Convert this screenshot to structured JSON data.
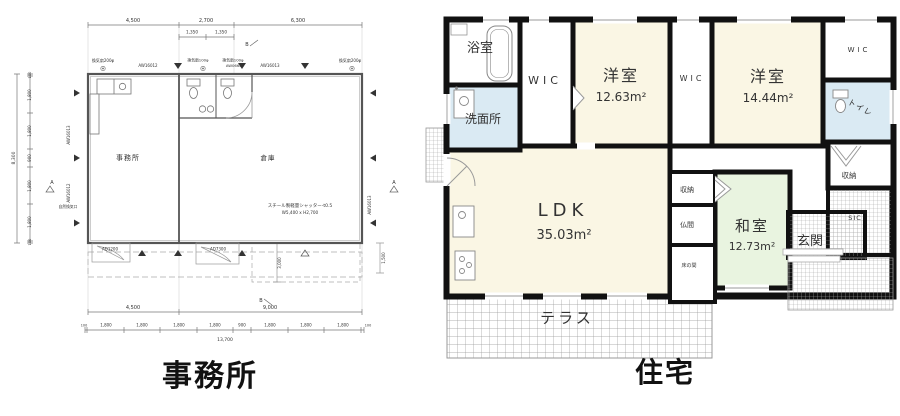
{
  "office": {
    "caption": "事務所",
    "rooms": {
      "office": "事務所",
      "warehouse": "倉庫"
    },
    "dims": {
      "top": [
        "4,500",
        "2,700",
        "6,300"
      ],
      "top_sub": [
        "1,350",
        "1,350"
      ],
      "left": [
        "100",
        "1,800",
        "1,800",
        "900",
        "1,800",
        "1,800",
        "100"
      ],
      "left_total": "8,300",
      "bottom_main": [
        "4,500",
        "9,000"
      ],
      "bottom_detail": [
        "100",
        "1,800",
        "1,800",
        "1,800",
        "1,800",
        "900",
        "1,800",
        "1,800",
        "1,800",
        "100"
      ],
      "bottom_total": "13,700",
      "opening_height": "3,000",
      "canopy_depth": "1,500"
    },
    "notes": {
      "fan200": "換気扇200φ",
      "fan100": "換気扇100φ",
      "aw16012": "AW16012",
      "aw06605": "AW06605",
      "aw16013": "AW16013",
      "vent": "自然換気口",
      "shutter1": "スチール製軽量シャッター-t0.5",
      "shutter2": "W5,400 x H2,700",
      "door_left": "AD1200",
      "door_mid": "AD7300",
      "marker_a": "A",
      "marker_b": "B"
    }
  },
  "house": {
    "caption": "住宅",
    "rooms": {
      "bathroom": "浴室",
      "washroom": "洗面所",
      "wic": "WIC",
      "bedroom1": "洋室",
      "bedroom1_area": "12.63m²",
      "bedroom2": "洋室",
      "bedroom2_area": "14.44m²",
      "toilet": "トイレ",
      "ldk": "LDK",
      "ldk_area": "35.03m²",
      "closet": "収納",
      "butsuma": "仏間",
      "tokonoma": "床の間",
      "washitsu": "和室",
      "washitsu_area": "12.73m²",
      "genkan": "玄関",
      "sic": "SIC",
      "terrace": "テラス"
    },
    "colors": {
      "room_cream": "#FAF6E4",
      "room_green": "#E9F4E0",
      "room_blue": "#DAEAF3",
      "wall": "#111111"
    }
  }
}
